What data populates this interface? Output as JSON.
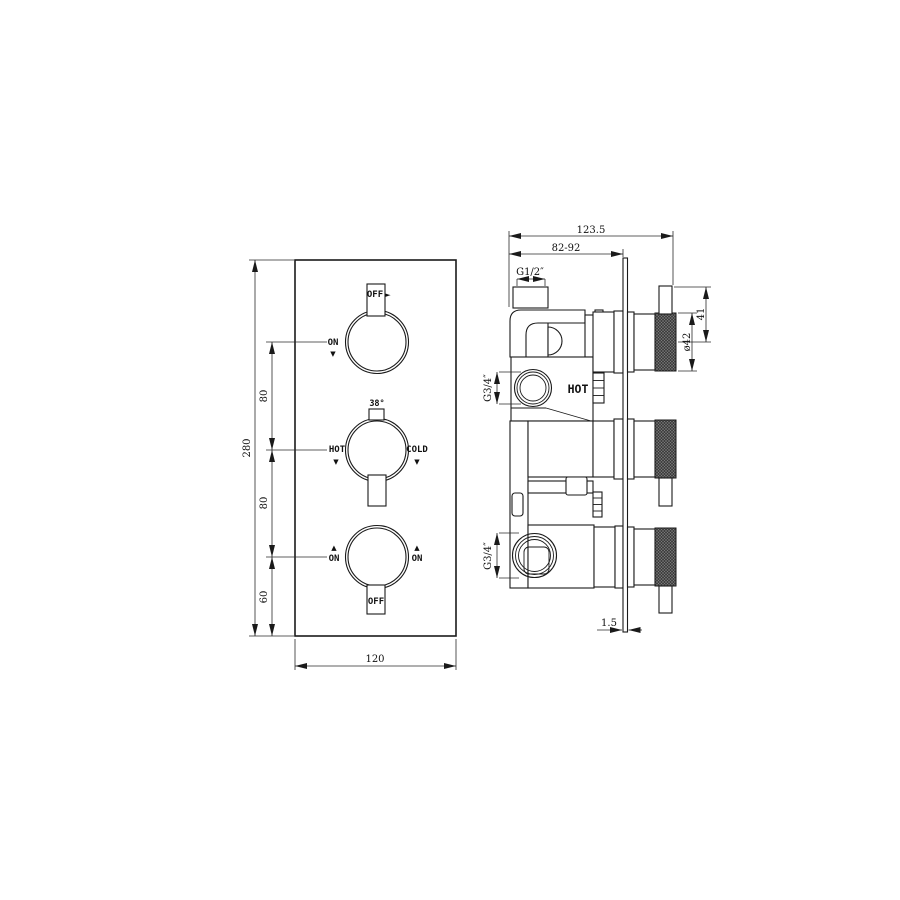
{
  "drawing": {
    "front_view": {
      "dim_height_total": "280",
      "dim_gap_top": "80",
      "dim_gap_mid": "80",
      "dim_gap_bottom": "60",
      "dim_width": "120",
      "knob_top": {
        "on": "ON",
        "off": "OFF"
      },
      "knob_mid": {
        "temp": "38°",
        "hot": "HOT",
        "cold": "COLD"
      },
      "knob_bottom": {
        "on_left": "ON",
        "on_right": "ON",
        "off": "OFF"
      }
    },
    "side_view": {
      "dim_depth_total": "123.5",
      "dim_wall_range": "82-92",
      "inlet_thread": "G1/2″",
      "outlet_thread_top": "G3/4″",
      "outlet_thread_bottom": "G3/4″",
      "dim_handle": "41",
      "dim_knob_diameter": "ø42",
      "dim_plate_thickness": "1.5",
      "hot_marking": "HOT"
    },
    "icons": {
      "triangle_down": "▼",
      "triangle_up": "▲",
      "triangle_right": "►"
    }
  }
}
